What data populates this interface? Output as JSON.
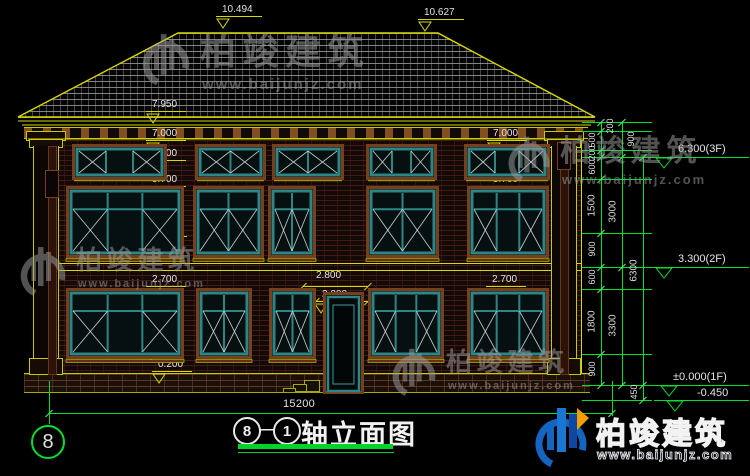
{
  "colors": {
    "yellow": "#d9d900",
    "green": "#00e02e",
    "white": "#e4e4e4",
    "teal": "#2e8585",
    "trim": "#74401e",
    "wm": "#9d9d9d",
    "blue": "#1565c0",
    "blue2": "#0d47a1",
    "orange": "#f59f00"
  },
  "axis": {
    "label": "8"
  },
  "title": {
    "circle1": "8",
    "circle2": "1",
    "dash": "—",
    "text": "轴立面图"
  },
  "brand": {
    "name": "柏竣建筑",
    "site": "www.baijunjz.com"
  },
  "bottom_dim": {
    "label": "15200",
    "y": 413,
    "x1": 49,
    "x2": 612,
    "tx": 283,
    "ty": 399,
    "ext": [
      [
        49,
        381,
        424
      ],
      [
        612,
        381,
        416
      ]
    ]
  },
  "markers": [
    {
      "t": "10.494",
      "x": 222,
      "y": 4,
      "w": 46
    },
    {
      "t": "10.627",
      "x": 424,
      "y": 7,
      "w": 46
    },
    {
      "t": "7.950",
      "x": 152,
      "y": 99,
      "w": 40
    },
    {
      "t": "7.000",
      "x": 152,
      "y": 128,
      "w": 40
    },
    {
      "t": "6.500",
      "x": 152,
      "y": 148,
      "w": 40
    },
    {
      "t": "5.700",
      "x": 152,
      "y": 174,
      "w": 40
    },
    {
      "t": "4.200",
      "x": 153,
      "y": 224,
      "w": 40
    },
    {
      "t": "2.700",
      "x": 152,
      "y": 274,
      "w": 40
    },
    {
      "t": "0.900",
      "x": 150,
      "y": 336,
      "w": 40
    },
    {
      "t": "0.200",
      "x": 158,
      "y": 359,
      "w": 40
    },
    {
      "t": "7.000",
      "x": 493,
      "y": 128,
      "w": 40
    },
    {
      "t": "6.500",
      "x": 493,
      "y": 148,
      "w": 40
    },
    {
      "t": "5.700",
      "x": 493,
      "y": 174,
      "w": 40
    },
    {
      "t": "4.200",
      "x": 493,
      "y": 224,
      "w": 40
    },
    {
      "t": "2.700",
      "x": 492,
      "y": 274,
      "w": 40
    },
    {
      "t": "0.900",
      "x": 492,
      "y": 336,
      "w": 40
    }
  ],
  "center_dims": [
    {
      "t": "2.800",
      "tx": 316,
      "ty": 270,
      "x1": 303,
      "x2": 368,
      "ly": 286,
      "tri": null
    },
    {
      "t": "2.200",
      "tx": 322,
      "ty": 289,
      "x1": 316,
      "x2": 368,
      "ly": 301,
      "tri": [
        314,
        303
      ]
    }
  ],
  "chains": [
    {
      "x": 601,
      "b": [
        122,
        131,
        150,
        157,
        179,
        233,
        267,
        289,
        354,
        385
      ],
      "l": [
        "200",
        "500",
        "200",
        "600",
        "1500",
        "900",
        "600",
        "1800",
        "900"
      ],
      "s": [
        "r",
        "l",
        "l",
        "l",
        "l",
        "l",
        "l",
        "l",
        "l"
      ]
    },
    {
      "x": 622,
      "b": [
        122,
        157,
        267,
        385
      ],
      "l": [
        "900",
        "3000",
        "3300"
      ],
      "s": [
        "r",
        "l",
        "l"
      ]
    },
    {
      "x": 643,
      "b": [
        157,
        385,
        400
      ],
      "l": [
        "6300",
        "450"
      ],
      "s": [
        "l",
        "l"
      ]
    }
  ],
  "ext_lines": {
    "x1": 582,
    "x2": 652,
    "ys": [
      122,
      131,
      150,
      157,
      179,
      233,
      267,
      289,
      354,
      385,
      400
    ]
  },
  "elevations": [
    {
      "t": "6.300(3F)",
      "y": 157,
      "x1": 646,
      "x2": 749,
      "tx": 678,
      "ty": 143,
      "trix": 655
    },
    {
      "t": "3.300(2F)",
      "y": 267,
      "x1": 646,
      "x2": 749,
      "tx": 678,
      "ty": 253,
      "trix": 655
    },
    {
      "t": "±0.000(1F)",
      "y": 385,
      "x1": 643,
      "x2": 749,
      "tx": 673,
      "ty": 371,
      "trix": 660
    },
    {
      "t": "-0.450",
      "y": 400,
      "x1": 654,
      "x2": 749,
      "tx": 697,
      "ty": 387,
      "trix": 666
    }
  ],
  "windows": [
    {
      "n": "window-3f-1",
      "x": 76,
      "y": 148,
      "w": 87,
      "h": 28,
      "c": 3,
      "t": 0
    },
    {
      "n": "window-3f-2",
      "x": 199,
      "y": 148,
      "w": 63,
      "h": 28,
      "c": 2,
      "t": 0
    },
    {
      "n": "window-3f-3",
      "x": 276,
      "y": 148,
      "w": 64,
      "h": 28,
      "c": 2,
      "t": 0
    },
    {
      "n": "window-3f-4",
      "x": 370,
      "y": 148,
      "w": 63,
      "h": 28,
      "c": 3,
      "t": 0
    },
    {
      "n": "window-3f-5",
      "x": 468,
      "y": 148,
      "w": 78,
      "h": 28,
      "c": 3,
      "t": 0
    },
    {
      "n": "window-2f-1",
      "x": 70,
      "y": 190,
      "w": 110,
      "h": 64,
      "c": 3,
      "t": 1
    },
    {
      "n": "window-2f-2",
      "x": 197,
      "y": 190,
      "w": 63,
      "h": 64,
      "c": 2,
      "t": 1
    },
    {
      "n": "window-2f-3",
      "x": 272,
      "y": 190,
      "w": 40,
      "h": 64,
      "c": 2,
      "t": 1
    },
    {
      "n": "window-2f-4",
      "x": 370,
      "y": 190,
      "w": 65,
      "h": 64,
      "c": 2,
      "t": 1
    },
    {
      "n": "window-2f-5",
      "x": 471,
      "y": 190,
      "w": 74,
      "h": 64,
      "c": 3,
      "t": 1
    },
    {
      "n": "window-1f-1",
      "x": 70,
      "y": 292,
      "w": 110,
      "h": 63,
      "c": 3,
      "t": 1
    },
    {
      "n": "window-1f-2",
      "x": 200,
      "y": 292,
      "w": 48,
      "h": 63,
      "c": 2,
      "t": 1
    },
    {
      "n": "window-1f-3",
      "x": 273,
      "y": 292,
      "w": 39,
      "h": 63,
      "c": 2,
      "t": 1
    },
    {
      "n": "window-1f-4",
      "x": 372,
      "y": 292,
      "w": 68,
      "h": 63,
      "c": 3,
      "t": 1
    },
    {
      "n": "window-1f-5",
      "x": 471,
      "y": 292,
      "w": 74,
      "h": 63,
      "c": 3,
      "t": 1
    }
  ],
  "door": {
    "x": 327,
    "y": 296,
    "w": 33,
    "h": 95
  },
  "watermarks": [
    {
      "x": 140,
      "y": 30,
      "cs": 36,
      "ls": 52
    },
    {
      "x": 506,
      "y": 133,
      "cs": 30,
      "ls": 46
    },
    {
      "x": 18,
      "y": 243,
      "cs": 26,
      "ls": 50
    },
    {
      "x": 390,
      "y": 345,
      "cs": 26,
      "ls": 48
    }
  ]
}
